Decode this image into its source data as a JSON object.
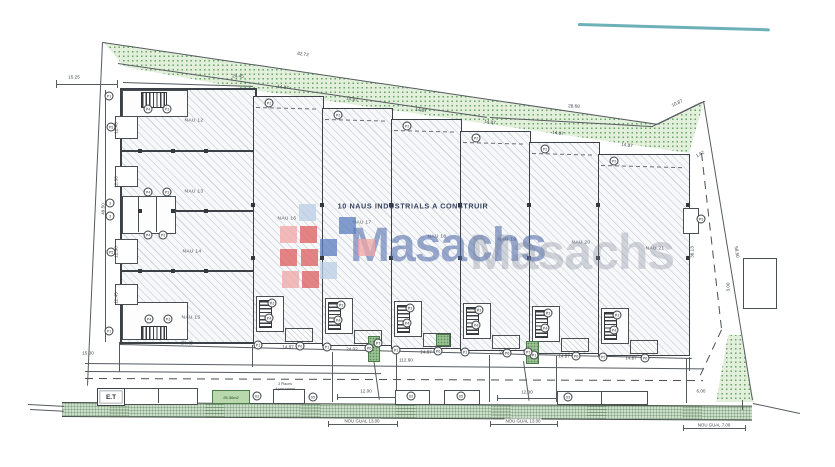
{
  "title_note": "10 NAUS INDUSTRIALS A CONSTRUIR",
  "watermark": {
    "front_text": "Masachs",
    "ghost_text": "Masachs",
    "front_color": "rgba(73,101,166,0.55)",
    "ghost_color": "rgba(128,138,152,0.33)",
    "logo_squares": [
      {
        "x": 299,
        "y": 204,
        "c": "#b9cfe6"
      },
      {
        "x": 339,
        "y": 217,
        "c": "#5b7cc0"
      },
      {
        "x": 280,
        "y": 226,
        "c": "#f2a6a6"
      },
      {
        "x": 300,
        "y": 226,
        "c": "#dd5c5c"
      },
      {
        "x": 320,
        "y": 239,
        "c": "#5b7cc0"
      },
      {
        "x": 358,
        "y": 239,
        "c": "#f2a6a6"
      },
      {
        "x": 280,
        "y": 249,
        "c": "#dd5c5c"
      },
      {
        "x": 301,
        "y": 249,
        "c": "#dd5c5c"
      },
      {
        "x": 320,
        "y": 262,
        "c": "#b9cfe6"
      },
      {
        "x": 282,
        "y": 271,
        "c": "#f2a6a6"
      },
      {
        "x": 302,
        "y": 271,
        "c": "#dd5c5c"
      }
    ]
  },
  "naves": [
    {
      "label": "NAU 12",
      "x": 194,
      "y": 121
    },
    {
      "label": "NAU 13",
      "x": 194,
      "y": 192
    },
    {
      "label": "NAU 14",
      "x": 192,
      "y": 252
    },
    {
      "label": "NAU 15",
      "x": 191,
      "y": 318
    },
    {
      "label": "NAU 16",
      "x": 287,
      "y": 219
    },
    {
      "label": "NAU 17",
      "x": 362,
      "y": 223
    },
    {
      "label": "NAU 18",
      "x": 437,
      "y": 237
    },
    {
      "label": "NAU 19",
      "x": 507,
      "y": 240
    },
    {
      "label": "NAU 20",
      "x": 581,
      "y": 243
    },
    {
      "label": "NAU 21",
      "x": 655,
      "y": 249
    }
  ],
  "dimensions": [
    {
      "t": "82.72",
      "x": 303,
      "y": 54,
      "r": 8
    },
    {
      "t": "28.68",
      "x": 574,
      "y": 106,
      "r": 3
    },
    {
      "t": "10.87",
      "x": 677,
      "y": 103,
      "r": -26
    },
    {
      "t": "15.25",
      "x": 74,
      "y": 77,
      "r": 0
    },
    {
      "t": "24.45",
      "x": 238,
      "y": 76,
      "r": 2
    },
    {
      "t": "14.87",
      "x": 283,
      "y": 87,
      "r": 8
    },
    {
      "t": "14.87",
      "x": 352,
      "y": 99,
      "r": 8
    },
    {
      "t": "14.87",
      "x": 421,
      "y": 110,
      "r": 8
    },
    {
      "t": "14.87",
      "x": 490,
      "y": 122,
      "r": 8
    },
    {
      "t": "14.87",
      "x": 558,
      "y": 133,
      "r": 8
    },
    {
      "t": "14.87",
      "x": 627,
      "y": 145,
      "r": 8
    },
    {
      "t": "1.62",
      "x": 700,
      "y": 154,
      "r": -30
    },
    {
      "t": "58.50",
      "x": 737,
      "y": 252,
      "r": 81
    },
    {
      "t": "36.13",
      "x": 692,
      "y": 252,
      "r": -90
    },
    {
      "t": "3.00",
      "x": 728,
      "y": 287,
      "r": -90
    },
    {
      "t": "49.50",
      "x": 103,
      "y": 209,
      "r": -90
    },
    {
      "t": "12.45",
      "x": 116,
      "y": 128,
      "r": -90
    },
    {
      "t": "12.30",
      "x": 116,
      "y": 182,
      "r": -90
    },
    {
      "t": "12.30",
      "x": 116,
      "y": 252,
      "r": -90
    },
    {
      "t": "12.45",
      "x": 116,
      "y": 298,
      "r": -90
    },
    {
      "t": "24.45",
      "x": 187,
      "y": 343,
      "r": 1
    },
    {
      "t": "15.00",
      "x": 88,
      "y": 353,
      "r": 0
    },
    {
      "t": "14.87",
      "x": 288,
      "y": 347,
      "r": 1
    },
    {
      "t": "14.87",
      "x": 426,
      "y": 352,
      "r": 1
    },
    {
      "t": "14.87",
      "x": 564,
      "y": 356,
      "r": 1
    },
    {
      "t": "14.87",
      "x": 631,
      "y": 358,
      "r": 1
    },
    {
      "t": "112.60",
      "x": 406,
      "y": 360,
      "r": 0
    },
    {
      "t": "12.00",
      "x": 366,
      "y": 391,
      "r": 0
    },
    {
      "t": "12.00",
      "x": 527,
      "y": 392,
      "r": 0
    },
    {
      "t": "6.00",
      "x": 701,
      "y": 391,
      "r": 0
    },
    {
      "t": "24.02",
      "x": 352,
      "y": 349,
      "r": 0
    },
    {
      "t": "24.02",
      "x": 505,
      "y": 352,
      "r": 0
    }
  ],
  "markers": [
    {
      "l": "P1",
      "x": 109,
      "y": 96
    },
    {
      "l": "P5",
      "x": 111,
      "y": 127
    },
    {
      "l": "P4",
      "x": 148,
      "y": 109
    },
    {
      "l": "P3",
      "x": 167,
      "y": 109
    },
    {
      "l": "P4",
      "x": 148,
      "y": 192
    },
    {
      "l": "P3",
      "x": 167,
      "y": 192
    },
    {
      "l": "3",
      "x": 110,
      "y": 203
    },
    {
      "l": "3",
      "x": 110,
      "y": 216
    },
    {
      "l": "P4",
      "x": 148,
      "y": 235
    },
    {
      "l": "P3",
      "x": 163,
      "y": 235
    },
    {
      "l": "P5",
      "x": 111,
      "y": 252
    },
    {
      "l": "P4",
      "x": 149,
      "y": 319
    },
    {
      "l": "P3",
      "x": 168,
      "y": 319
    },
    {
      "l": "P1",
      "x": 109,
      "y": 331
    },
    {
      "l": "P2",
      "x": 269,
      "y": 103
    },
    {
      "l": "P2",
      "x": 338,
      "y": 115
    },
    {
      "l": "P2",
      "x": 407,
      "y": 126
    },
    {
      "l": "P2",
      "x": 476,
      "y": 138
    },
    {
      "l": "P2",
      "x": 545,
      "y": 149
    },
    {
      "l": "P2",
      "x": 614,
      "y": 161
    },
    {
      "l": "P3",
      "x": 272,
      "y": 303
    },
    {
      "l": "P4",
      "x": 269,
      "y": 318
    },
    {
      "l": "P3",
      "x": 341,
      "y": 305
    },
    {
      "l": "P4",
      "x": 338,
      "y": 320
    },
    {
      "l": "P3",
      "x": 410,
      "y": 308
    },
    {
      "l": "P4",
      "x": 407,
      "y": 323
    },
    {
      "l": "P3",
      "x": 479,
      "y": 310
    },
    {
      "l": "P4",
      "x": 476,
      "y": 325
    },
    {
      "l": "P3",
      "x": 548,
      "y": 313
    },
    {
      "l": "P4",
      "x": 545,
      "y": 328
    },
    {
      "l": "P3",
      "x": 617,
      "y": 315
    },
    {
      "l": "P4",
      "x": 614,
      "y": 330
    },
    {
      "l": "P1",
      "x": 258,
      "y": 345
    },
    {
      "l": "P1",
      "x": 327,
      "y": 347
    },
    {
      "l": "P1",
      "x": 396,
      "y": 350
    },
    {
      "l": "P1",
      "x": 465,
      "y": 352
    },
    {
      "l": "P1",
      "x": 534,
      "y": 355
    },
    {
      "l": "P1",
      "x": 603,
      "y": 357
    },
    {
      "l": "P6",
      "x": 300,
      "y": 346
    },
    {
      "l": "P6",
      "x": 369,
      "y": 348
    },
    {
      "l": "P6",
      "x": 438,
      "y": 351
    },
    {
      "l": "P6",
      "x": 507,
      "y": 353
    },
    {
      "l": "P6",
      "x": 576,
      "y": 356
    },
    {
      "l": "P6",
      "x": 645,
      "y": 358
    },
    {
      "l": "P7",
      "x": 378,
      "y": 343
    },
    {
      "l": "P7",
      "x": 528,
      "y": 352
    },
    {
      "l": "P5",
      "x": 701,
      "y": 219
    },
    {
      "l": "63",
      "x": 257,
      "y": 396
    },
    {
      "l": "65",
      "x": 313,
      "y": 397
    },
    {
      "l": "63",
      "x": 411,
      "y": 396
    },
    {
      "l": "65",
      "x": 461,
      "y": 396
    },
    {
      "l": "63",
      "x": 568,
      "y": 397
    }
  ],
  "street": {
    "et_label": "E.T",
    "green_area_label": "25.30m2",
    "parking_note_line1": "3 Places",
    "parking_note_line2": "Aparcament",
    "guals": [
      {
        "t": "NOU GUAL 13.00",
        "x": 362,
        "y": 421
      },
      {
        "t": "NOU GUAL 13.00",
        "x": 523,
        "y": 421
      },
      {
        "t": "NOU GUAL 7.00",
        "x": 714,
        "y": 425
      }
    ]
  },
  "colors": {
    "line": "#565b60",
    "wall": "#3c4147",
    "green_band": "#e2efdb",
    "sidewalk": "#ccdfca",
    "scan_artifact": "#53a2ab",
    "note_text": "#33415e"
  }
}
